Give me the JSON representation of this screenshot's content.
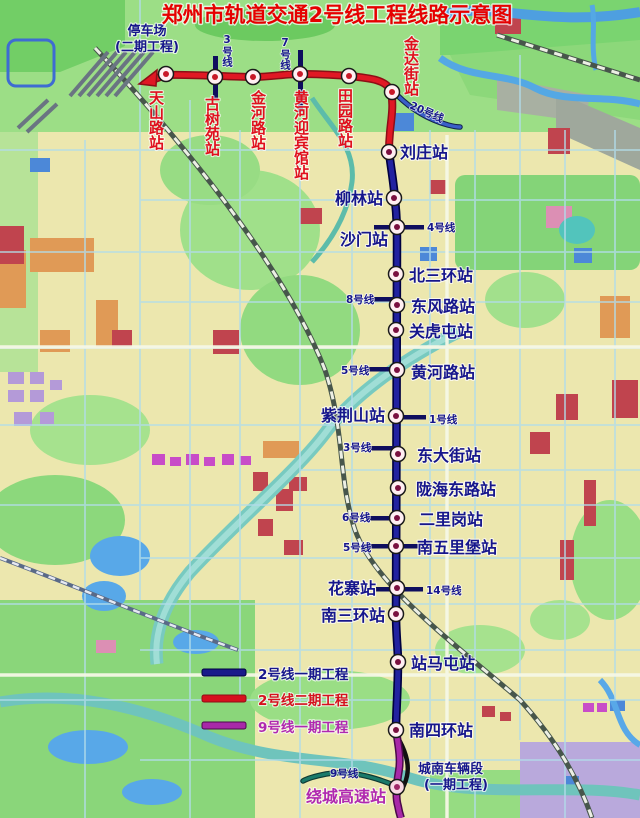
{
  "title": "郑州市轨道交通2号线工程线路示意图",
  "parking": {
    "line1": "停车场",
    "line2": "(二期工程)"
  },
  "depot": {
    "line1": "城南车辆段",
    "line2": "(一期工程)"
  },
  "stations": [
    {
      "name": "天山路站",
      "line": "line2-phase2"
    },
    {
      "name": "古树苑站",
      "line": "line2-phase2"
    },
    {
      "name": "金河路站",
      "line": "line2-phase2"
    },
    {
      "name": "黄河迎宾馆站",
      "line": "line2-phase2"
    },
    {
      "name": "田园路站",
      "line": "line2-phase2"
    },
    {
      "name": "金达街站",
      "line": "line2-phase2"
    },
    {
      "name": "刘庄站",
      "line": "line2-phase1"
    },
    {
      "name": "柳林站",
      "line": "line2-phase1"
    },
    {
      "name": "沙门站",
      "line": "line2-phase1"
    },
    {
      "name": "北三环站",
      "line": "line2-phase1"
    },
    {
      "name": "东风路站",
      "line": "line2-phase1"
    },
    {
      "name": "关虎屯站",
      "line": "line2-phase1"
    },
    {
      "name": "黄河路站",
      "line": "line2-phase1"
    },
    {
      "name": "紫荆山站",
      "line": "line2-phase1"
    },
    {
      "name": "东大街站",
      "line": "line2-phase1"
    },
    {
      "name": "陇海东路站",
      "line": "line2-phase1"
    },
    {
      "name": "二里岗站",
      "line": "line2-phase1"
    },
    {
      "name": "南五里堡站",
      "line": "line2-phase1"
    },
    {
      "name": "花寨站",
      "line": "line2-phase1"
    },
    {
      "name": "南三环站",
      "line": "line2-phase1"
    },
    {
      "name": "站马屯站",
      "line": "line2-phase1"
    },
    {
      "name": "南四环站",
      "line": "line2-phase1"
    },
    {
      "name": "绕城高速站",
      "line": "line9-phase1"
    }
  ],
  "interchange_labels": [
    "3号线",
    "7号线",
    "20号线",
    "4号线",
    "8号线",
    "5号线",
    "1号线",
    "3号线",
    "6号线",
    "5号线",
    "14号线",
    "9号线"
  ],
  "legend": {
    "items": [
      {
        "label": "2号线一期工程",
        "color": "#1A1A8A"
      },
      {
        "label": "2号线二期工程",
        "color": "#D6101E"
      },
      {
        "label": "9号线一期工程",
        "color": "#A828A8"
      }
    ]
  },
  "colors": {
    "line2_phase1": "#1A1A8A",
    "line2_phase2": "#D6101E",
    "line9_phase1": "#A828A8",
    "title_red": "#E60000",
    "station_label_blue": "#16168C",
    "station_label_red": "#E0101E",
    "station_label_magenta": "#B028B0"
  }
}
